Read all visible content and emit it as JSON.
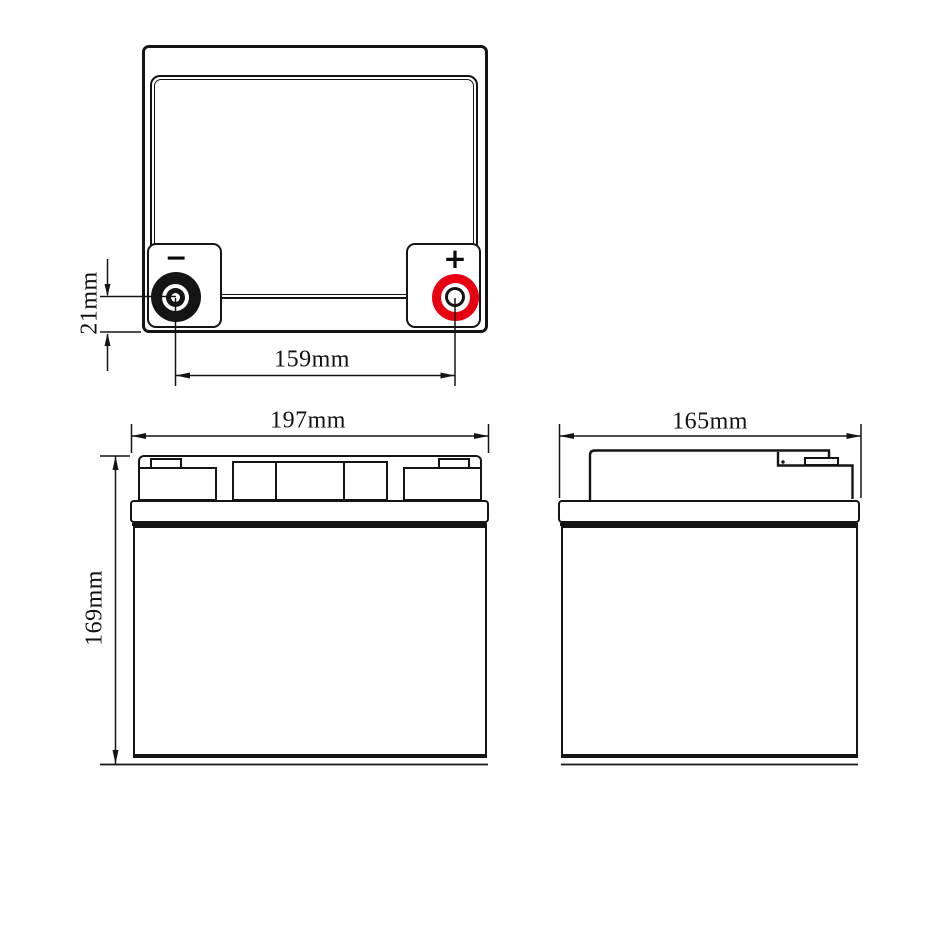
{
  "drawing": {
    "title": "Battery three-view dimensional drawing",
    "colors": {
      "line": "#141414",
      "positive_terminal": "#e60012",
      "negative_terminal": "#141414",
      "background": "#ffffff"
    },
    "top_view": {
      "negative_symbol": "−",
      "positive_symbol": "+",
      "terminal_height_label": "21mm",
      "terminal_spacing_label": "159mm"
    },
    "front_view": {
      "width_label": "197mm",
      "height_label": "169mm"
    },
    "side_view": {
      "width_label": "165mm"
    }
  }
}
